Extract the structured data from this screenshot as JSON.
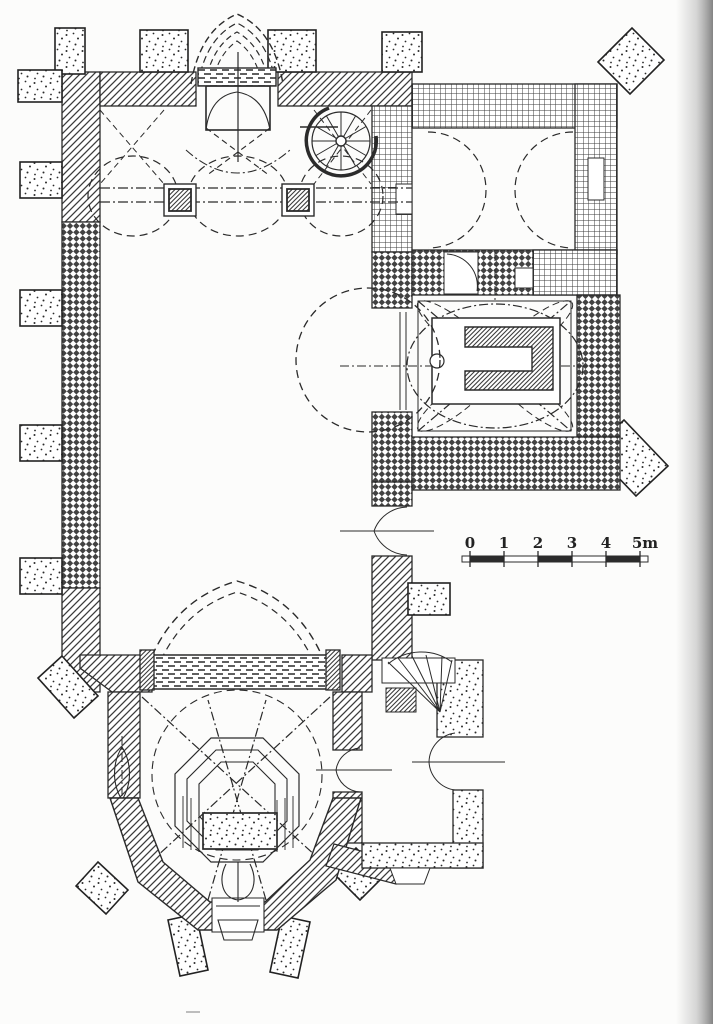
{
  "figure": {
    "kind": "scanned-church-floor-plan",
    "ink_color": "#2b2b2b",
    "paper_color": "#fcfcfb",
    "scan_shadow_color": "#8f8f8f"
  },
  "scale_bar": {
    "unit": "m",
    "tick_labels": [
      "0",
      "1",
      "2",
      "3",
      "4",
      "5m"
    ]
  }
}
